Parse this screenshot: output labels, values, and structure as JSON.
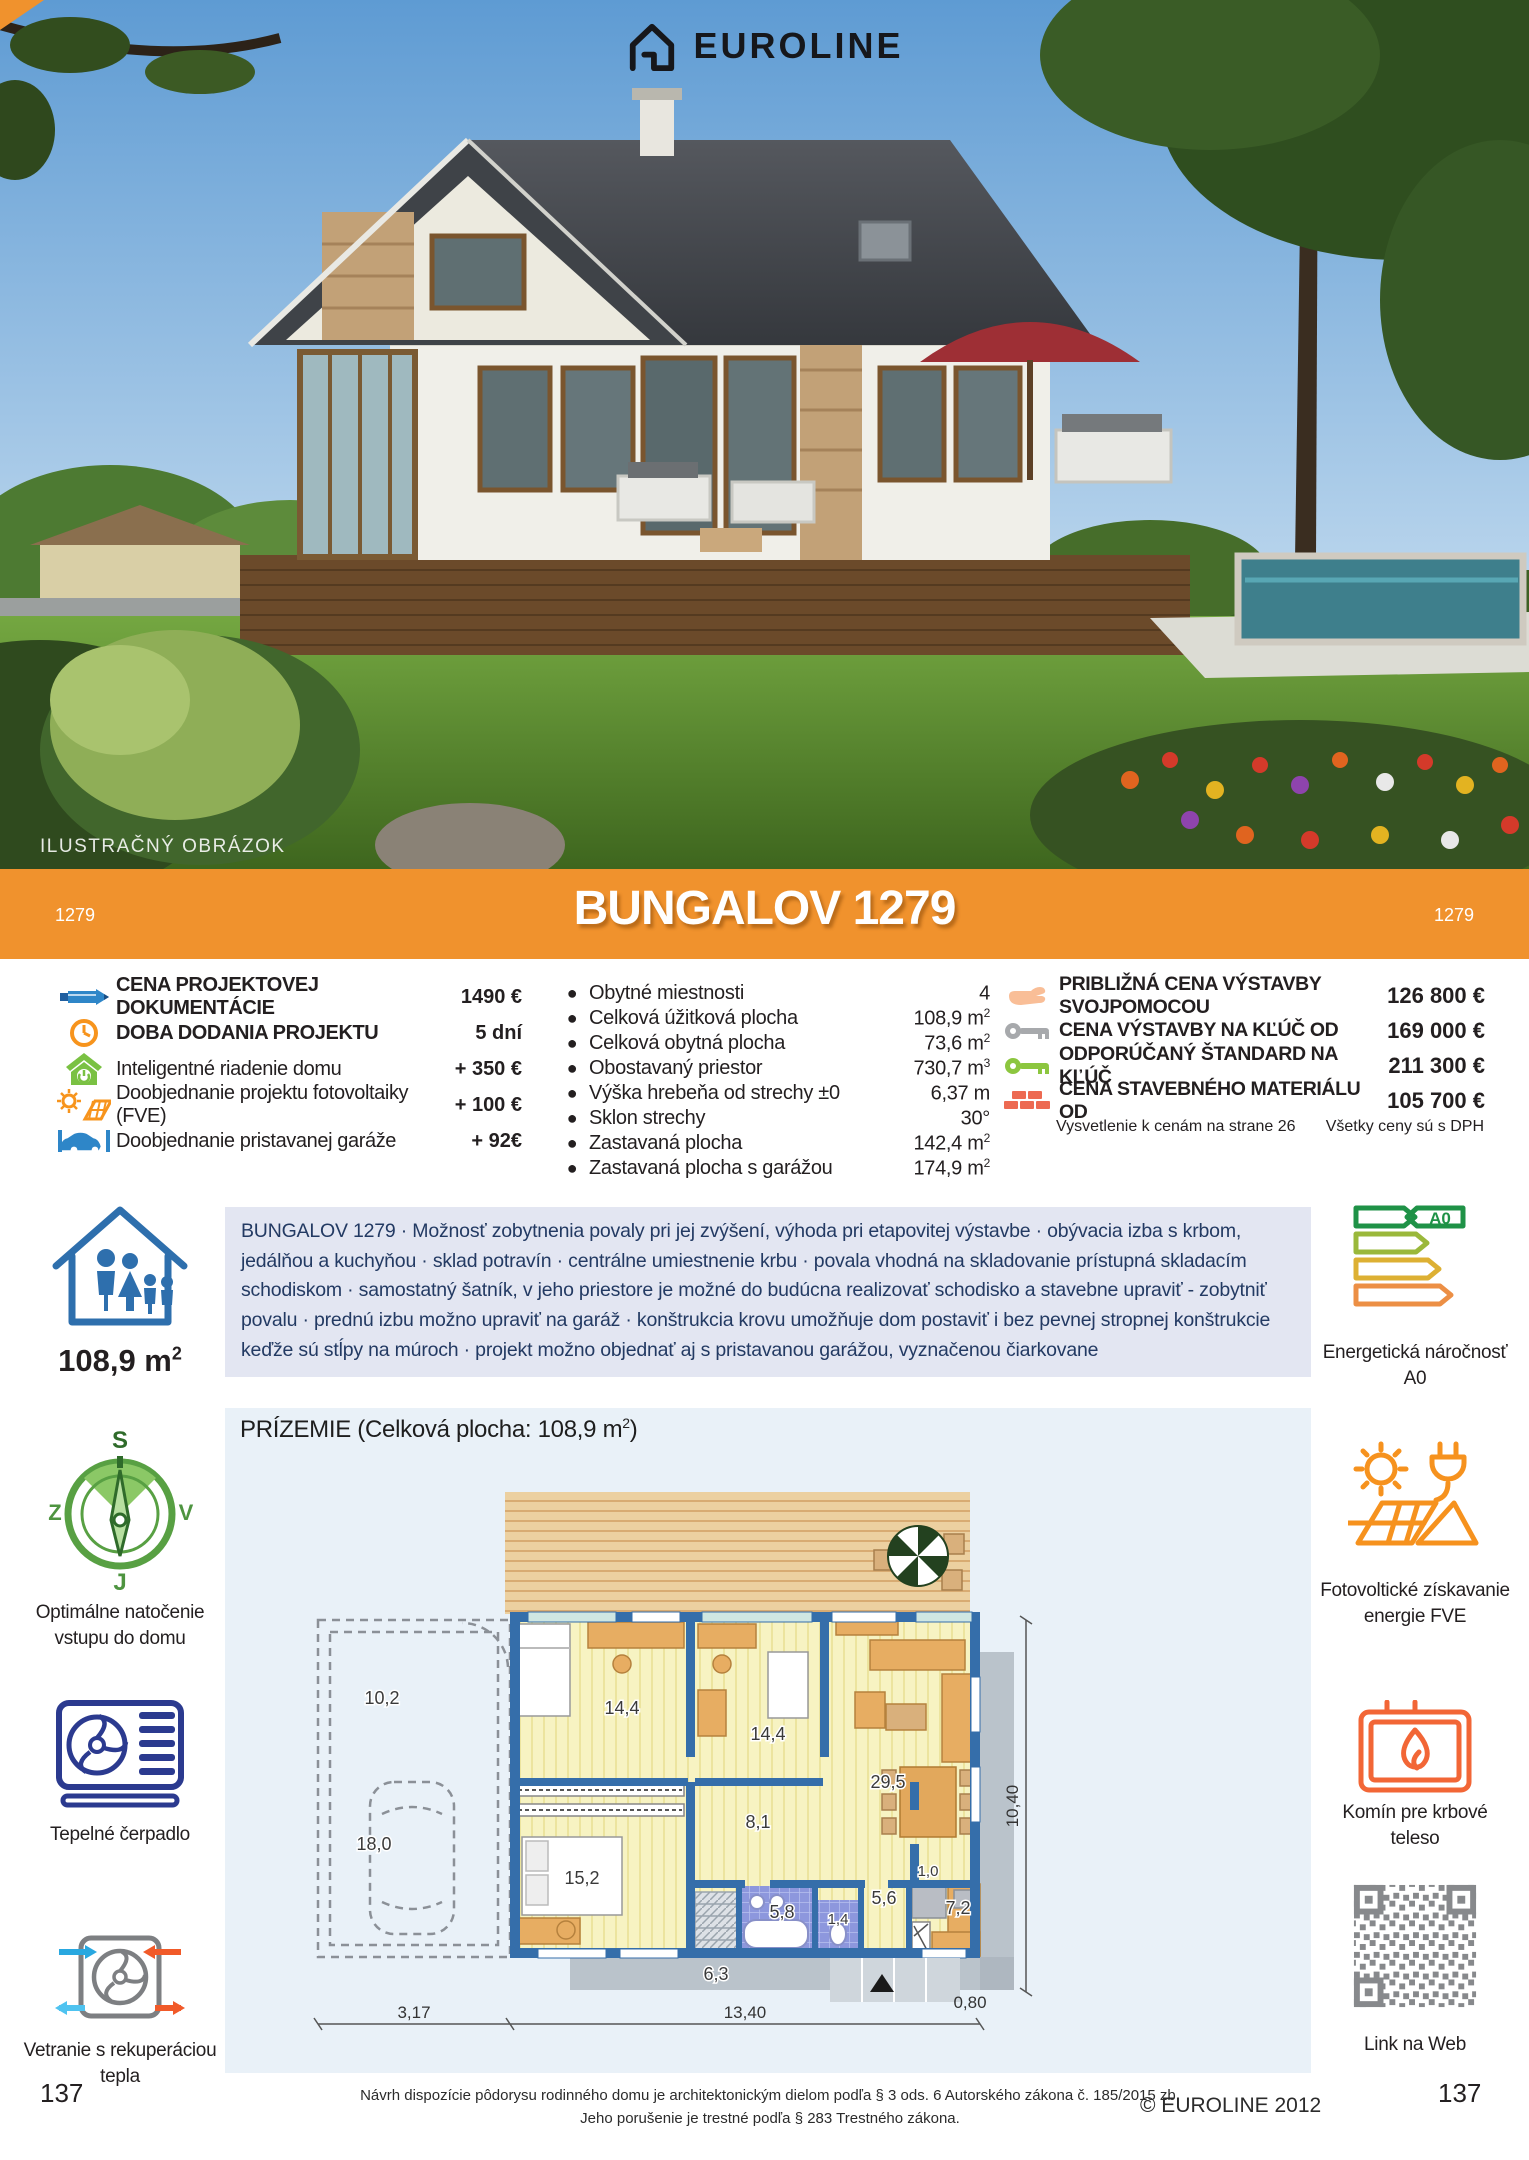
{
  "colors": {
    "accent_orange": "#F0922D",
    "panel_blue": "#E9F1F8",
    "description_bg": "#E3E6F2",
    "wall_blue": "#356EAA"
  },
  "header": {
    "brand": "EUROLINE",
    "watermark": "ILUSTRAČNÝ OBRÁZOK"
  },
  "banner": {
    "left_code": "1279",
    "title": "BUNGALOV 1279",
    "right_code": "1279"
  },
  "pricing_left": {
    "rows": [
      {
        "icon": "pencil-icon",
        "label": "CENA PROJEKTOVEJ DOKUMENTÁCIE",
        "value": "1490 €"
      },
      {
        "icon": "clock-icon",
        "label": "DOBA DODANIA PROJEKTU",
        "value": "5 dní"
      },
      {
        "icon": "smart-home-icon",
        "label": "Inteligentné riadenie domu",
        "value": "+ 350 €"
      },
      {
        "icon": "solar-project-icon",
        "label": "Doobjednanie projektu fotovoltaiky (FVE)",
        "value": "+ 100 €"
      },
      {
        "icon": "garage-icon",
        "label": "Doobjednanie pristavanej garáže",
        "value": "+ 92€"
      }
    ]
  },
  "specs": {
    "rows": [
      {
        "label": "Obytné miestnosti",
        "value": "4",
        "sup": ""
      },
      {
        "label": "Celková úžitková plocha",
        "value": "108,9 m",
        "sup": "2"
      },
      {
        "label": "Celková obytná plocha",
        "value": "73,6 m",
        "sup": "2"
      },
      {
        "label": "Obostavaný priestor",
        "value": "730,7 m",
        "sup": "3"
      },
      {
        "label": "Výška hrebeňa od strechy ±0",
        "value": "6,37 m",
        "sup": ""
      },
      {
        "label": "Sklon strechy",
        "value": "30°",
        "sup": ""
      },
      {
        "label": "Zastavaná plocha",
        "value": "142,4 m",
        "sup": "2"
      },
      {
        "label": "Zastavaná plocha s garážou",
        "value": "174,9 m",
        "sup": "2"
      }
    ]
  },
  "pricing_right": {
    "rows": [
      {
        "icon": "hand-icon",
        "label": "PRIBLIŽNÁ CENA VÝSTAVBY SVOJPOMOCOU",
        "value": "126 800 €"
      },
      {
        "icon": "key-grey-icon",
        "label": "CENA VÝSTAVBY NA KĽÚČ OD",
        "value": "169 000 €"
      },
      {
        "icon": "key-green-icon",
        "label": "ODPORÚČANÝ ŠTANDARD NA KĽÚČ",
        "value": "211 300 €"
      },
      {
        "icon": "bricks-icon",
        "label": "CENA STAVEBNÉHO MATERIÁLU OD",
        "value": "105 700 €"
      }
    ],
    "note_left": "Vysvetlenie k cenám na strane 26",
    "note_right": "Všetky ceny sú s DPH"
  },
  "description": "BUNGALOV 1279 · Možnosť zobytnenia povaly pri jej zvýšení, výhoda pri etapovitej výstavbe · obývacia izba s krbom, jedálňou a kuchyňou · sklad potravín · centrálne umiestnenie krbu · povala vhodná na skladovanie prístupná skladacím schodiskom · samostatný šatník, v jeho priestore je možné do budúcna realizovať schodisko a stavebne upraviť - zobytniť povalu · prednú izbu možno upraviť na garáž · konštrukcia krovu umožňuje dom postaviť i bez pevnej stropnej konštrukcie keďže sú stĺpy na múroch ·  projekt možno objednať aj s pristavanou garážou, vyznačenou čiarkovane",
  "sidebar_left": {
    "area_value": "108,9 m",
    "area_sup": "2",
    "compass": {
      "n": "S",
      "w": "Z",
      "e": "V",
      "s": "J",
      "caption": "Optimálne natočenie vstupu do domu"
    },
    "heatpump_caption": "Tepelné čerpadlo",
    "ventilation_caption": "Vetranie s rekuperáciou tepla"
  },
  "sidebar_right": {
    "energy_badge": "A0",
    "energy_caption": "Energetická náročnosť A0",
    "fve_caption": "Fotovoltické získavanie energie FVE",
    "chimney_caption": "Komín pre krbové teleso",
    "qr_caption": "Link na Web"
  },
  "floorplan": {
    "title_prefix": "PRÍZEMIE (Celková plocha: 108,9 m",
    "title_sup": "2",
    "title_suffix": ")",
    "rooms": [
      "10,2",
      "18,0",
      "14,4",
      "14,4",
      "29,5",
      "8,1",
      "15,2",
      "6,3",
      "5,8",
      "1,4",
      "5,6",
      "1,0",
      "7,2"
    ],
    "dims": {
      "bottom_left": "3,17",
      "bottom_main": "13,40",
      "bottom_right": "0,80",
      "right": "10,40"
    }
  },
  "footer": {
    "left_page": "137",
    "right_page": "137",
    "legal_line1": "Návrh dispozície pôdorysu rodinného domu je architektonickým dielom podľa § 3 ods. 6 Autorského zákona č. 185/2015 zb.",
    "legal_line2": "Jeho porušenie je trestné podľa § 283 Trestného zákona.",
    "copyright": "© EUROLINE 2012"
  }
}
